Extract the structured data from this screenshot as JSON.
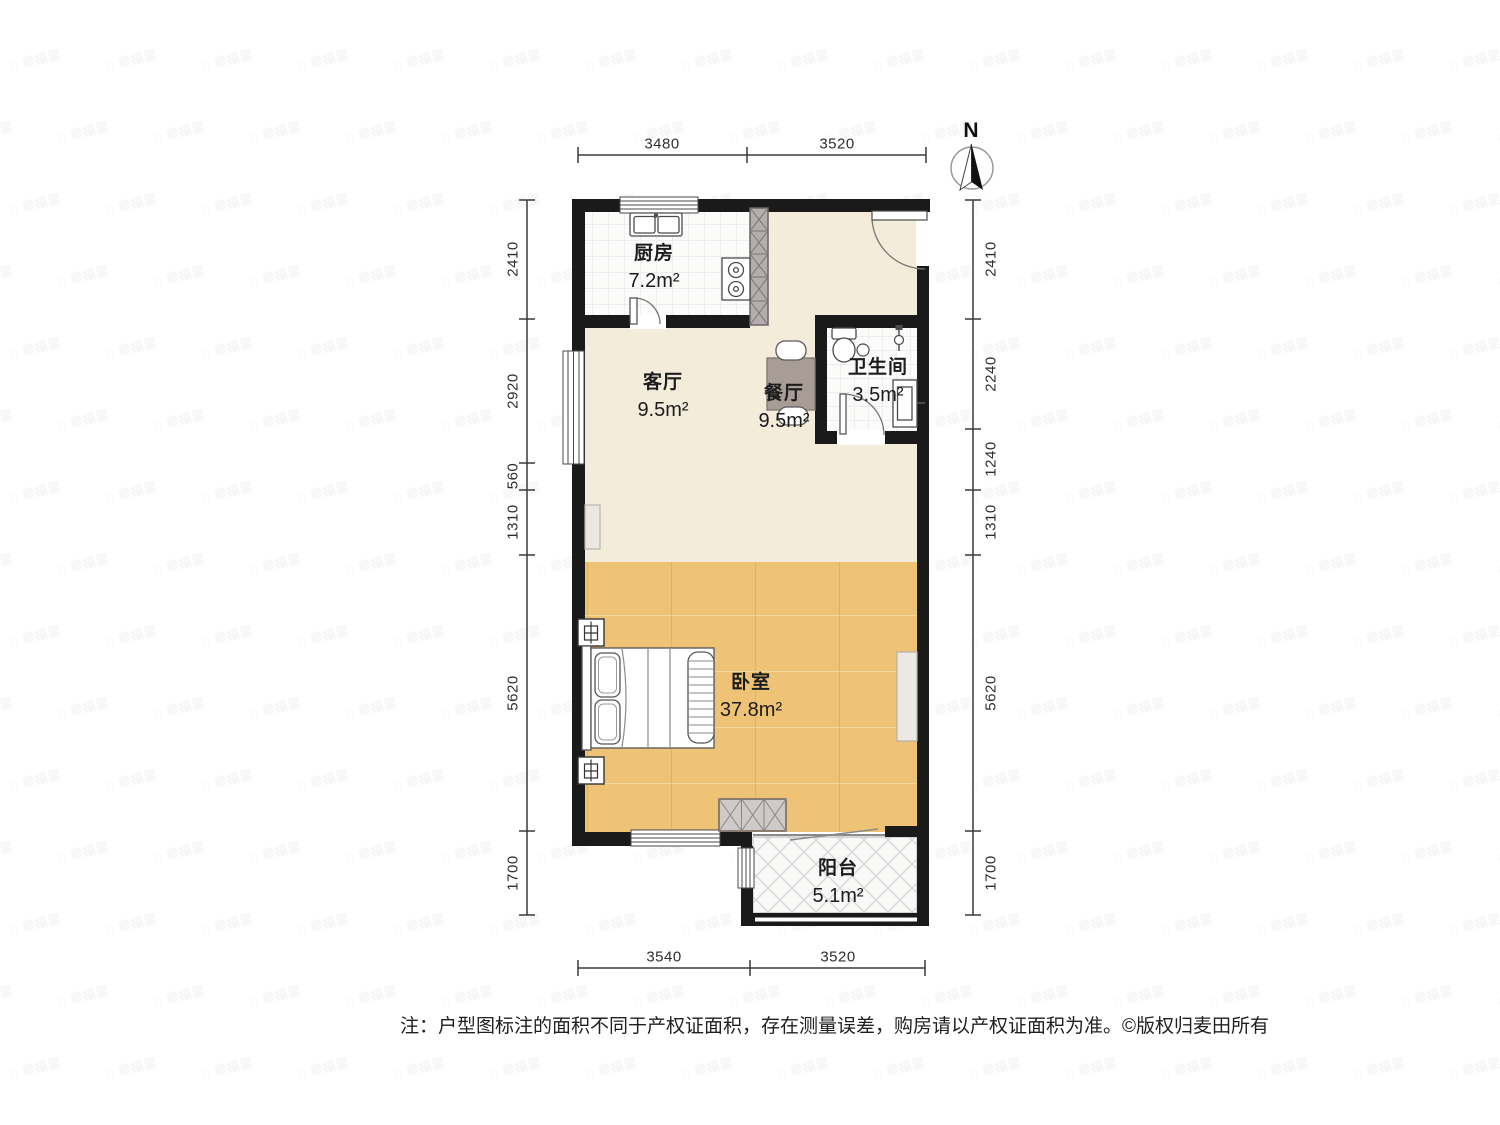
{
  "watermark": {
    "icon_glyph": "⌂",
    "text": "幸福里"
  },
  "compass": {
    "north_label": "N"
  },
  "rooms": {
    "kitchen": {
      "name": "厨房",
      "area": "7.2m²"
    },
    "living_room": {
      "name": "客厅",
      "area": "9.5m²"
    },
    "dining_room": {
      "name": "餐厅",
      "area": "9.5m²"
    },
    "bathroom": {
      "name": "卫生间",
      "area": "3.5m²"
    },
    "bedroom": {
      "name": "卧室",
      "area": "37.8m²"
    },
    "balcony": {
      "name": "阳台",
      "area": "5.1m²"
    }
  },
  "dimensions_mm": {
    "top": [
      "3480",
      "3520"
    ],
    "bottom": [
      "3540",
      "3520"
    ],
    "left": [
      "2410",
      "2920",
      "560",
      "1310",
      "5620",
      "1700"
    ],
    "right": [
      "2410",
      "2240",
      "1240",
      "1310",
      "5620",
      "1700"
    ]
  },
  "footer": {
    "note": "注：户型图标注的面积不同于产权证面积，存在测量误差，购房请以产权证面积为准。",
    "copyright": "©版权归麦田所有"
  },
  "colors": {
    "wall": "#1a1a1a",
    "living_floor": "#f3ecdb",
    "bedroom_floor": "#eec376",
    "tile_floor": "#fbfbfa",
    "balcony_floor": "#f8f8f7",
    "hatch_gray": "#b5adad",
    "wardrobe_gray": "#cfc9c9",
    "table_gray": "#a79d96",
    "dim_line": "#3a3a3a"
  }
}
